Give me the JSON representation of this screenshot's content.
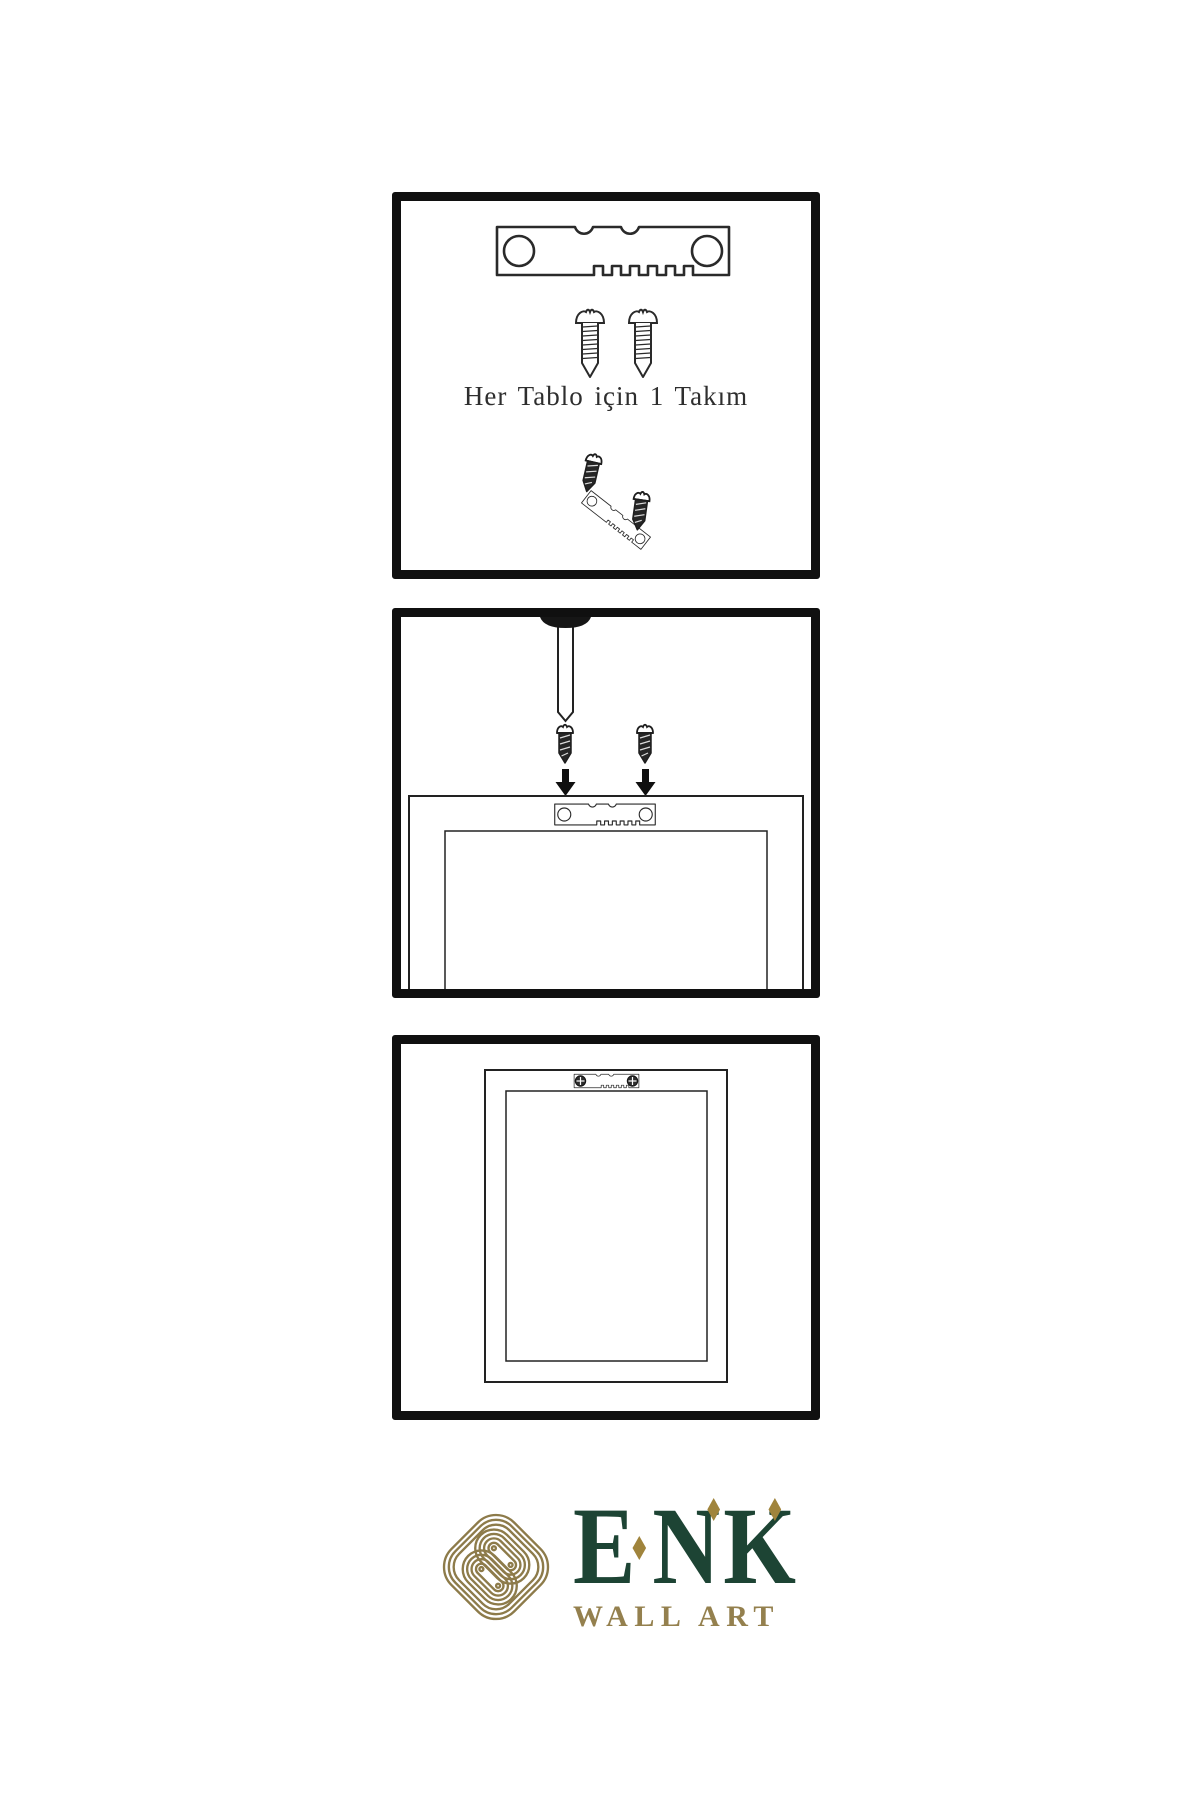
{
  "page": {
    "background": "#ffffff",
    "diagram_line_color": "#262626",
    "panel_border_color": "#101010"
  },
  "steps": [
    {
      "id": "hardware-kit",
      "caption": "Her Tablo için 1 Takım",
      "items": [
        "sawtooth-hanger",
        "screw",
        "screw",
        "screw-into-hanger-demo"
      ]
    },
    {
      "id": "attach-hanger-to-frame",
      "caption": "",
      "items": [
        "wall-nail",
        "screw",
        "screw",
        "down-arrow",
        "down-arrow",
        "frame-back",
        "sawtooth-hanger"
      ]
    },
    {
      "id": "frame-hung-on-wall",
      "caption": "",
      "items": [
        "frame-front",
        "installed-sawtooth-hanger"
      ]
    }
  ],
  "logo": {
    "brand": "ENK",
    "letters": [
      "E",
      "N",
      "K"
    ],
    "tagline": "WALL ART",
    "colors": {
      "brand_green": "#1d4434",
      "gold": "#8d7b4a",
      "diamond_gold": "#a0843c",
      "tagline_gold": "#94804e"
    }
  }
}
